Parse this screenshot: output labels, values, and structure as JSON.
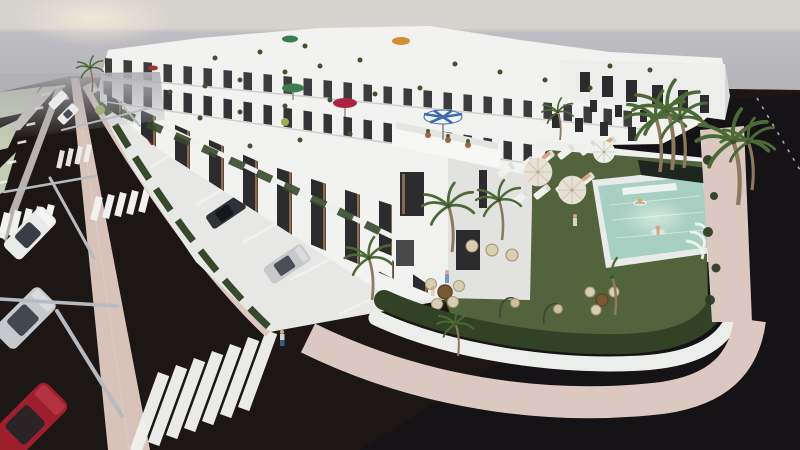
{
  "scene": {
    "description": "Elevated aerial 3D architectural rendering of a modern white townhouse development with rooftop terraces and colored parasols. A corner communal garden holds a turquoise swimming pool with two swimmers, rows of white sun loungers under cream parasols, wicker seating, hanging egg chairs and palm trees, all enclosed by a curved hedge, white wall and pink paved sidewalk. Dark asphalt streets with zebra crossings, a pink median strip, leaning street lamps and parked cars (white, silver, red) border the block under a hazy overcast sky.",
    "setting": "exterior, hazy daylight with faint sun glow at upper left",
    "view": "three-quarter aerial perspective"
  },
  "objects": {
    "townhouse_rows": 4,
    "rooftop_parasol_colors": [
      "green",
      "green",
      "crimson",
      "orange",
      "blue-white-striped"
    ],
    "poolside_parasols": [
      "cream",
      "cream",
      "white"
    ],
    "sun_loungers": 10,
    "sunbathers": 3,
    "pool_swimmers": 2,
    "street_cars": [
      "white",
      "silver",
      "red"
    ],
    "driveway_cars": [
      "dark-gray",
      "silver",
      "red",
      "white",
      "white"
    ],
    "street_lamps": 3,
    "zebra_crossings": 5,
    "palm_trees": 12,
    "pedestrians": 3,
    "garden_furniture": [
      "wicker tub chairs",
      "round rattan tables",
      "hanging egg chairs"
    ]
  },
  "palette": {
    "sky-top": "#d6d2cd",
    "sky-glow": "#f0e8da",
    "sky-horizon": "#bfbec2",
    "sky-low": "#b1b0b5",
    "distant-green": "#c8d2b9",
    "asphalt": "#1c1614",
    "asphalt-right": "#121217",
    "median": "#d7c3b9",
    "sidewalk-pink": "#dbc8c0",
    "paving-light": "#c9c3bd",
    "verge-green": "#c2cdb1",
    "lawn": "#53633c",
    "hedge": "#36492a",
    "hedge-dark": "#2b3c20",
    "building-white": "#f2f2f1",
    "building-shade": "#e0e0de",
    "window-dark": "#2c2c2f",
    "window-wood": "#8a6a4a",
    "pool-water": "#a7cfc2",
    "pool-light": "#d2e9dd",
    "umbrella-green": "#3e7c50",
    "umbrella-crimson": "#ac2344",
    "umbrella-orange": "#d49034",
    "umbrella-blue": "#3c6dab",
    "umbrella-cream": "#e7e2d5",
    "stripe-white": "#f1f1ef",
    "lamp-gray": "#b6bbc2",
    "car-white": "#e9eaea",
    "car-silver": "#c6c8cb",
    "car-red": "#9e1f2b",
    "car-dark": "#2e3236",
    "trunk": "#8c7a5e",
    "palm-green": "#4c6a37",
    "skin": "#d7a783",
    "wicker": "#d8cfb2",
    "table-brown": "#7a5834"
  }
}
